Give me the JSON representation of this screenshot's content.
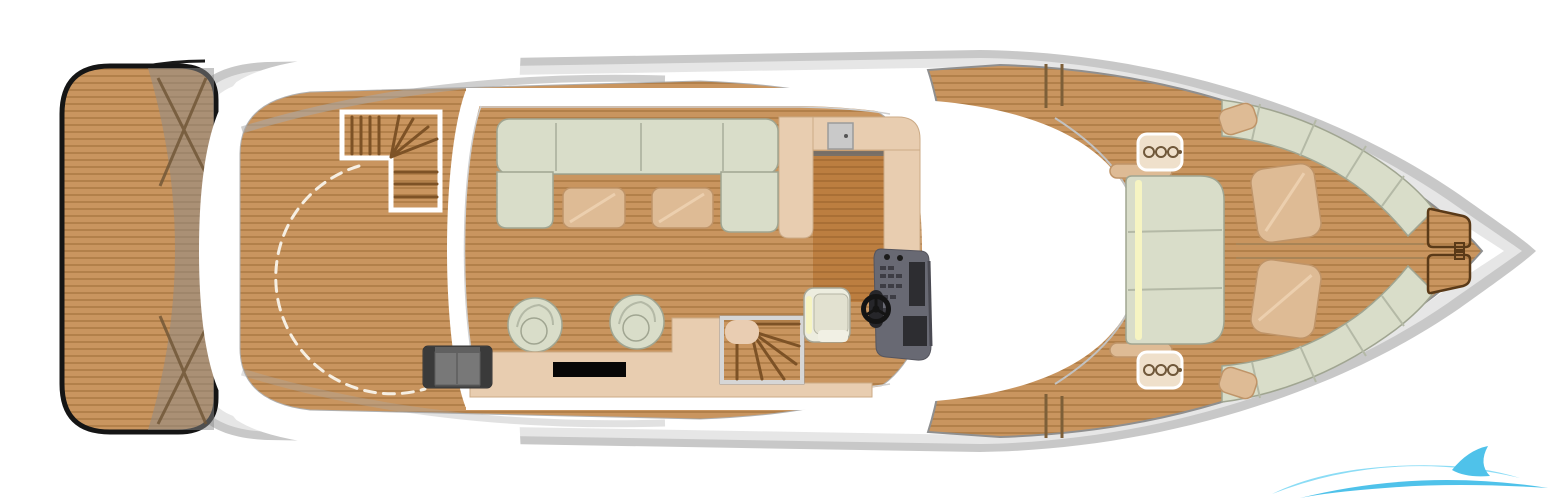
{
  "title": "Motor yacht main-deck floor plan, top view",
  "palette": {
    "deck_wood": "#c9955f",
    "deck_wood_stripe": "#b2804a",
    "galley_wood": "#bc7e40",
    "galley_wood_stripe": "#a96f35",
    "upholstery": "#d9ddc9",
    "upholstery_border": "#a0a591",
    "upholstery_divider": "#b4b9a6",
    "cushion_tan": "#debb95",
    "cushion_border": "#bf9468",
    "counter_tan": "#e8cdb0",
    "counter_border": "#cbaa86",
    "hull_gray": "#c8c8c8",
    "hull_mid": "#e6e6e6",
    "platform_outline": "#151515",
    "console_gray": "#686973",
    "console_dark": "#2d2d31",
    "bench_dark": "#4a4a4a",
    "bench_mid": "#787878",
    "tv_black": "#070707",
    "accent_yellow": "#f6f4c2",
    "tread_brown": "#7d5226",
    "logo_cyan": "#3cbce8",
    "logo_cyan_light": "#7fd9f5"
  },
  "areas": [
    {
      "id": "swim-platform"
    },
    {
      "id": "aft-deck"
    },
    {
      "id": "flybridge-stairs"
    },
    {
      "id": "salon"
    },
    {
      "id": "galley"
    },
    {
      "id": "helm-station"
    },
    {
      "id": "companionway-stairs"
    },
    {
      "id": "foredeck-side-decks"
    },
    {
      "id": "bow-lounge"
    }
  ],
  "furniture": [
    {
      "id": "u-shaped-sofa"
    },
    {
      "id": "coffee-table",
      "count": 2
    },
    {
      "id": "swivel-armchair",
      "count": 2
    },
    {
      "id": "tv-sideboard-with-tv"
    },
    {
      "id": "aft-bench-seat"
    },
    {
      "id": "galley-counter-with-sink"
    },
    {
      "id": "helm-console-with-wheel"
    },
    {
      "id": "helm-seat"
    },
    {
      "id": "foredeck-sun-pad"
    },
    {
      "id": "bow-bench",
      "count": 2
    },
    {
      "id": "bow-cushion",
      "count": 2
    },
    {
      "id": "anchor-locker-hatch",
      "count": 2
    }
  ],
  "watermark": {
    "shape": "wave-swoosh",
    "position": "bottom-right"
  }
}
